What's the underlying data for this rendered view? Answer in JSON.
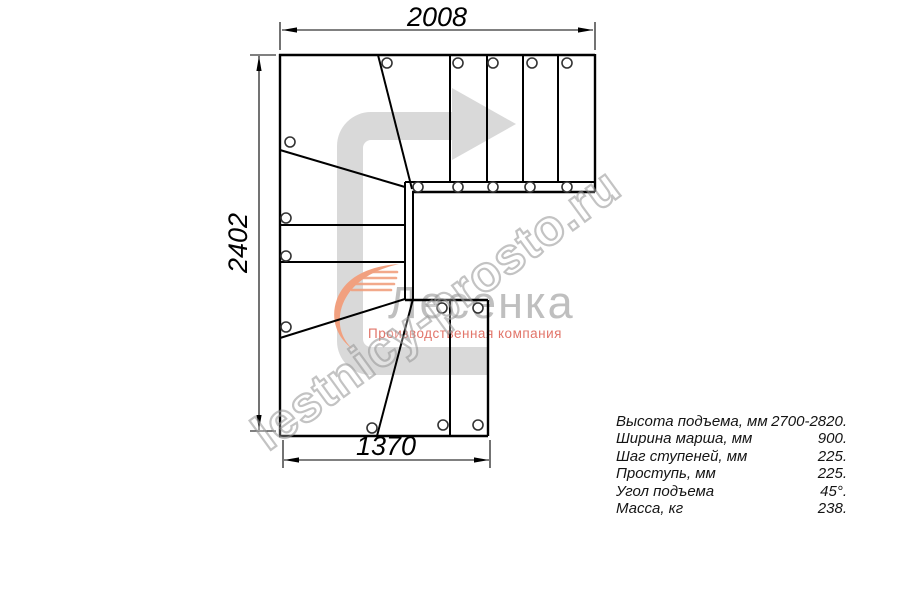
{
  "drawing_title": "L-shaped staircase plan view",
  "dimensions": {
    "top": "2008",
    "left": "2402",
    "bottom": "1370"
  },
  "specs": {
    "rows": [
      {
        "label": "Высота подъема, мм",
        "value": "2700-2820."
      },
      {
        "label": "Ширина марша, мм",
        "value": "900."
      },
      {
        "label": "Шаг ступеней, мм",
        "value": "225."
      },
      {
        "label": "Проступь, мм",
        "value": "225."
      },
      {
        "label": "Угол подъема",
        "value": "45°."
      },
      {
        "label": "Масса, кг",
        "value": "238."
      }
    ]
  },
  "logo": {
    "name": "Лесенка",
    "tagline": "Производственная компания"
  },
  "watermark": "lestnicy-prosto.ru",
  "colors": {
    "line": "#000000",
    "direction_arrow": "#d9d9d9",
    "logo_text": "#bfbfbf",
    "logo_tagline": "#e2756a",
    "logo_swoosh": "#f1a07f",
    "watermark_outline": "#919191"
  }
}
